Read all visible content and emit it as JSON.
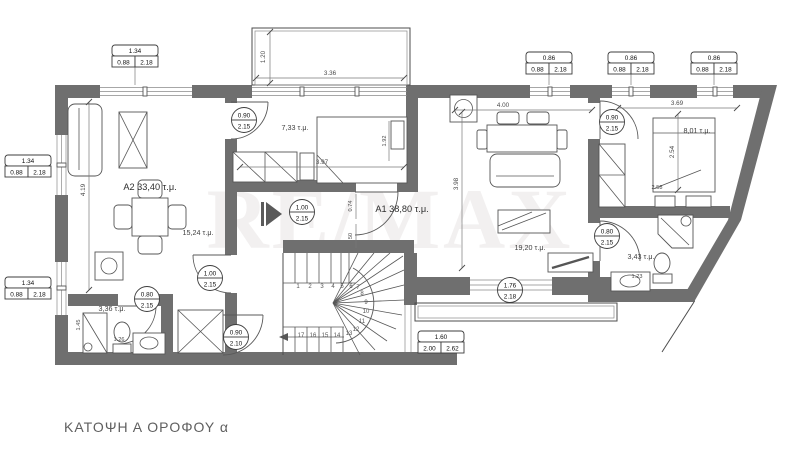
{
  "title": "ΚΑΤΟΨΗ Α ΟΡΟΦΟΥ α",
  "watermark": "RE/MAX",
  "apartments": {
    "a2": "A2 33,40 τ.μ.",
    "a1": "A1 38,80 τ.μ."
  },
  "rooms": {
    "bedroom_a2": "7,33 τ.μ.",
    "living_a2": "15,24 τ.μ.",
    "bath_a2": "3,36 τ.μ.",
    "living_a1": "19,20 τ.μ.",
    "bedroom_a1": "8,01 τ.μ.",
    "bath_a1": "3,43 τ.μ."
  },
  "window_tags": {
    "top_left": {
      "w": "1.34",
      "sill": "0.88",
      "h": "2.18"
    },
    "left_upper": {
      "w": "1.34",
      "sill": "0.88",
      "h": "2.18"
    },
    "left_lower": {
      "w": "1.34",
      "sill": "0.88",
      "h": "2.18"
    },
    "top_1": {
      "w": "0.86",
      "sill": "0.88",
      "h": "2.18"
    },
    "top_2": {
      "w": "0.86",
      "sill": "0.88",
      "h": "2.18"
    },
    "top_3": {
      "w": "0.86",
      "sill": "0.88",
      "h": "2.18"
    },
    "terrace": {
      "w": "1.60",
      "sill": "2.00",
      "h": "2.62"
    }
  },
  "door_tags": {
    "bedroom_a2": {
      "w": "0.90",
      "h": "2.15"
    },
    "entry_a2": {
      "w": "1.00",
      "h": "2.15"
    },
    "bath_a2": {
      "w": "0.80",
      "h": "2.15"
    },
    "shaft": {
      "w": "0.90",
      "h": "2.10"
    },
    "entry_a1": {
      "w": "1.00",
      "h": "2.15"
    },
    "bedroom_a1": {
      "w": "0.90",
      "h": "2.15"
    },
    "bath_a1": {
      "w": "0.80",
      "h": "2.15"
    },
    "living_window_a1": {
      "w": "1.76",
      "h": "2.18"
    }
  },
  "dims": {
    "balcony_w": "3.36",
    "balcony_d": "1.20",
    "bedroom_a2_w": "3.97",
    "living_a1_w": "4.00",
    "bedroom_a1_w": "3.69",
    "bedroom_a1_d": "2.54",
    "bed_a1_l": "2.58",
    "hall_a1_d": "3.98",
    "door_off": "0.74",
    "closet_d": "50",
    "living_a2_h": "4.19",
    "bath_a2_h": "1.45",
    "bed_a2_w": "1.92",
    "bath_a2_w": "1.26",
    "bath_a1_w": "1.23"
  },
  "stairs": {
    "numbers": [
      "1",
      "2",
      "3",
      "4",
      "5",
      "6",
      "7",
      "8",
      "9",
      "10",
      "11",
      "12",
      "13",
      "14",
      "15",
      "16",
      "17"
    ]
  },
  "colors": {
    "wall": "#6f6f6f",
    "line": "#4c4c4c",
    "dim": "#4a4a4a"
  }
}
